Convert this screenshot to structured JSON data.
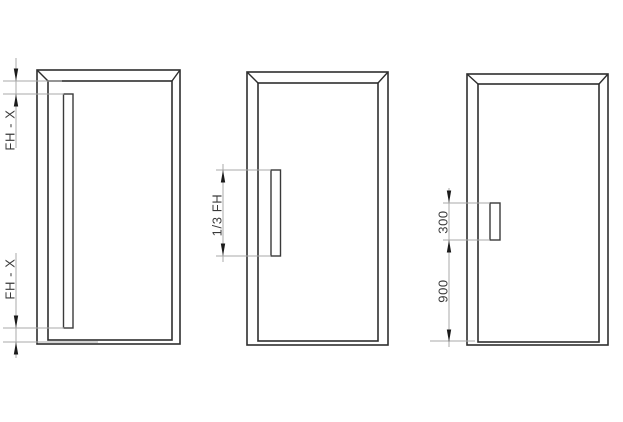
{
  "figure": {
    "type": "technical-drawing",
    "subject": "door handle position variants",
    "colors": {
      "background": "#ffffff",
      "outline": "#2e2e2e",
      "dimension_lines": "#a8a8a8",
      "arrows": "#1b1b1b",
      "text": "#3a3a3a"
    },
    "doors": [
      {
        "id": "full-length-handle-door",
        "labels": {
          "top_gap": "FH - X",
          "bottom_gap": "FH - X"
        }
      },
      {
        "id": "one-third-handle-door",
        "labels": {
          "handle_length": "1/3 FH"
        }
      },
      {
        "id": "short-handle-door",
        "labels": {
          "handle_length": "300",
          "height_from_bottom": "900"
        }
      }
    ]
  }
}
